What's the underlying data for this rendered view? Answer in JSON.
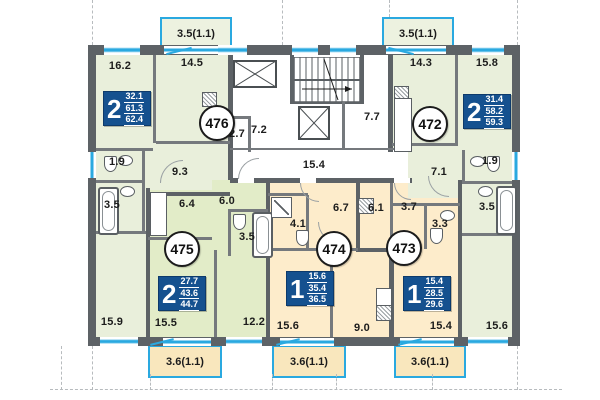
{
  "plan_title": "Residential floor plan, apartments 472-476",
  "colors": {
    "wall": "#5d6266",
    "partition": "#75797d",
    "balcony_blue": "#2aa9e0",
    "badge_blue": "#15518f",
    "apartment_green_light": "#e9efdb",
    "apartment_green": "#e2ecc8",
    "apartment_cream": "#fdeccb",
    "balcony_cream": "#f9e7bd",
    "core_white": "#ffffff"
  },
  "apartments": {
    "a476": {
      "number": "476",
      "type": "2",
      "area_living": "32.1",
      "area_usable": "61.3",
      "area_total": "62.4",
      "rooms": {
        "living": "16.2",
        "bedroom": "14.5",
        "hall": "9.3",
        "wc": "1.9",
        "bath": "3.5",
        "bedroom2": "15.9"
      },
      "balcony": "3.5(1.1)"
    },
    "a472": {
      "number": "472",
      "type": "2",
      "area_living": "31.4",
      "area_usable": "58.2",
      "area_total": "59.3",
      "rooms": {
        "bedroom": "14.3",
        "living": "15.8",
        "hall": "7.1",
        "wc": "1.9",
        "bath": "3.5",
        "bedroom2": "15.6"
      },
      "balcony": "3.5(1.1)"
    },
    "a475": {
      "number": "475",
      "type": "2",
      "area_living": "27.7",
      "area_usable": "43.6",
      "area_total": "44.7",
      "rooms": {
        "kitchen": "6.4",
        "hall": "6.0",
        "bath": "3.5",
        "living": "15.5",
        "bedroom": "12.2"
      },
      "balcony": "3.6(1.1)"
    },
    "a474": {
      "number": "474",
      "type": "1",
      "area_living": "15.6",
      "area_usable": "35.4",
      "area_total": "36.5",
      "rooms": {
        "bath": "4.1",
        "hall": "6.7",
        "living": "15.6",
        "kitchen": "9.0"
      },
      "balcony": "3.6(1.1)"
    },
    "a473": {
      "number": "473",
      "type": "1",
      "area_living": "15.4",
      "area_usable": "28.5",
      "area_total": "29.6",
      "rooms": {
        "kitchen": "6.1",
        "hall": "3.7",
        "bath": "3.3",
        "living": "15.4"
      },
      "balcony": "3.6(1.1)"
    }
  },
  "core": {
    "vestibule": "2.7",
    "lobby_left": "7.2",
    "lobby_right": "7.7",
    "corridor": "15.4"
  }
}
